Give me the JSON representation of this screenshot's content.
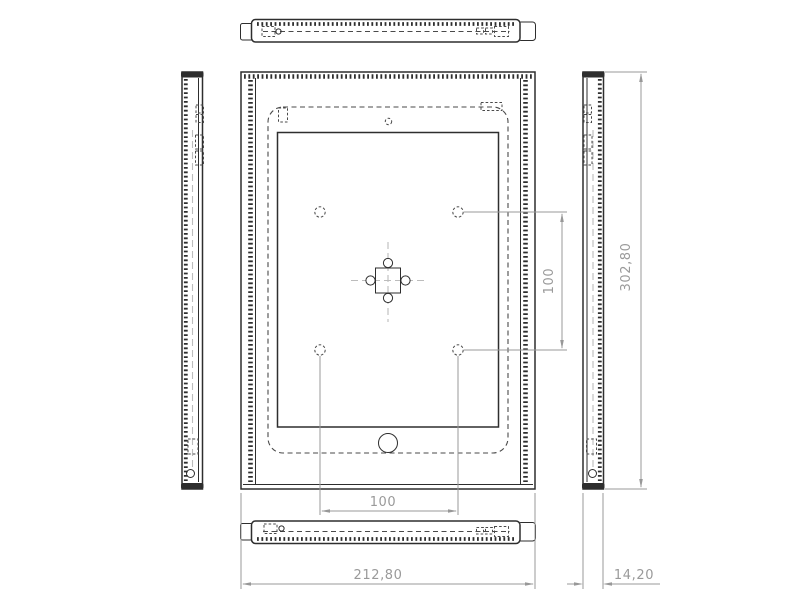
{
  "drawing": {
    "colors": {
      "edge": "#2e2e2e",
      "hidden_line": "#4a4a4a",
      "centerline": "#bcbcbc",
      "dimension": "#989898",
      "background": "#ffffff"
    },
    "dimensions": {
      "overall_width": "212,80",
      "overall_height": "302,80",
      "depth": "14,20",
      "hole_spacing_horizontal": "100",
      "hole_spacing_vertical": "100"
    }
  }
}
